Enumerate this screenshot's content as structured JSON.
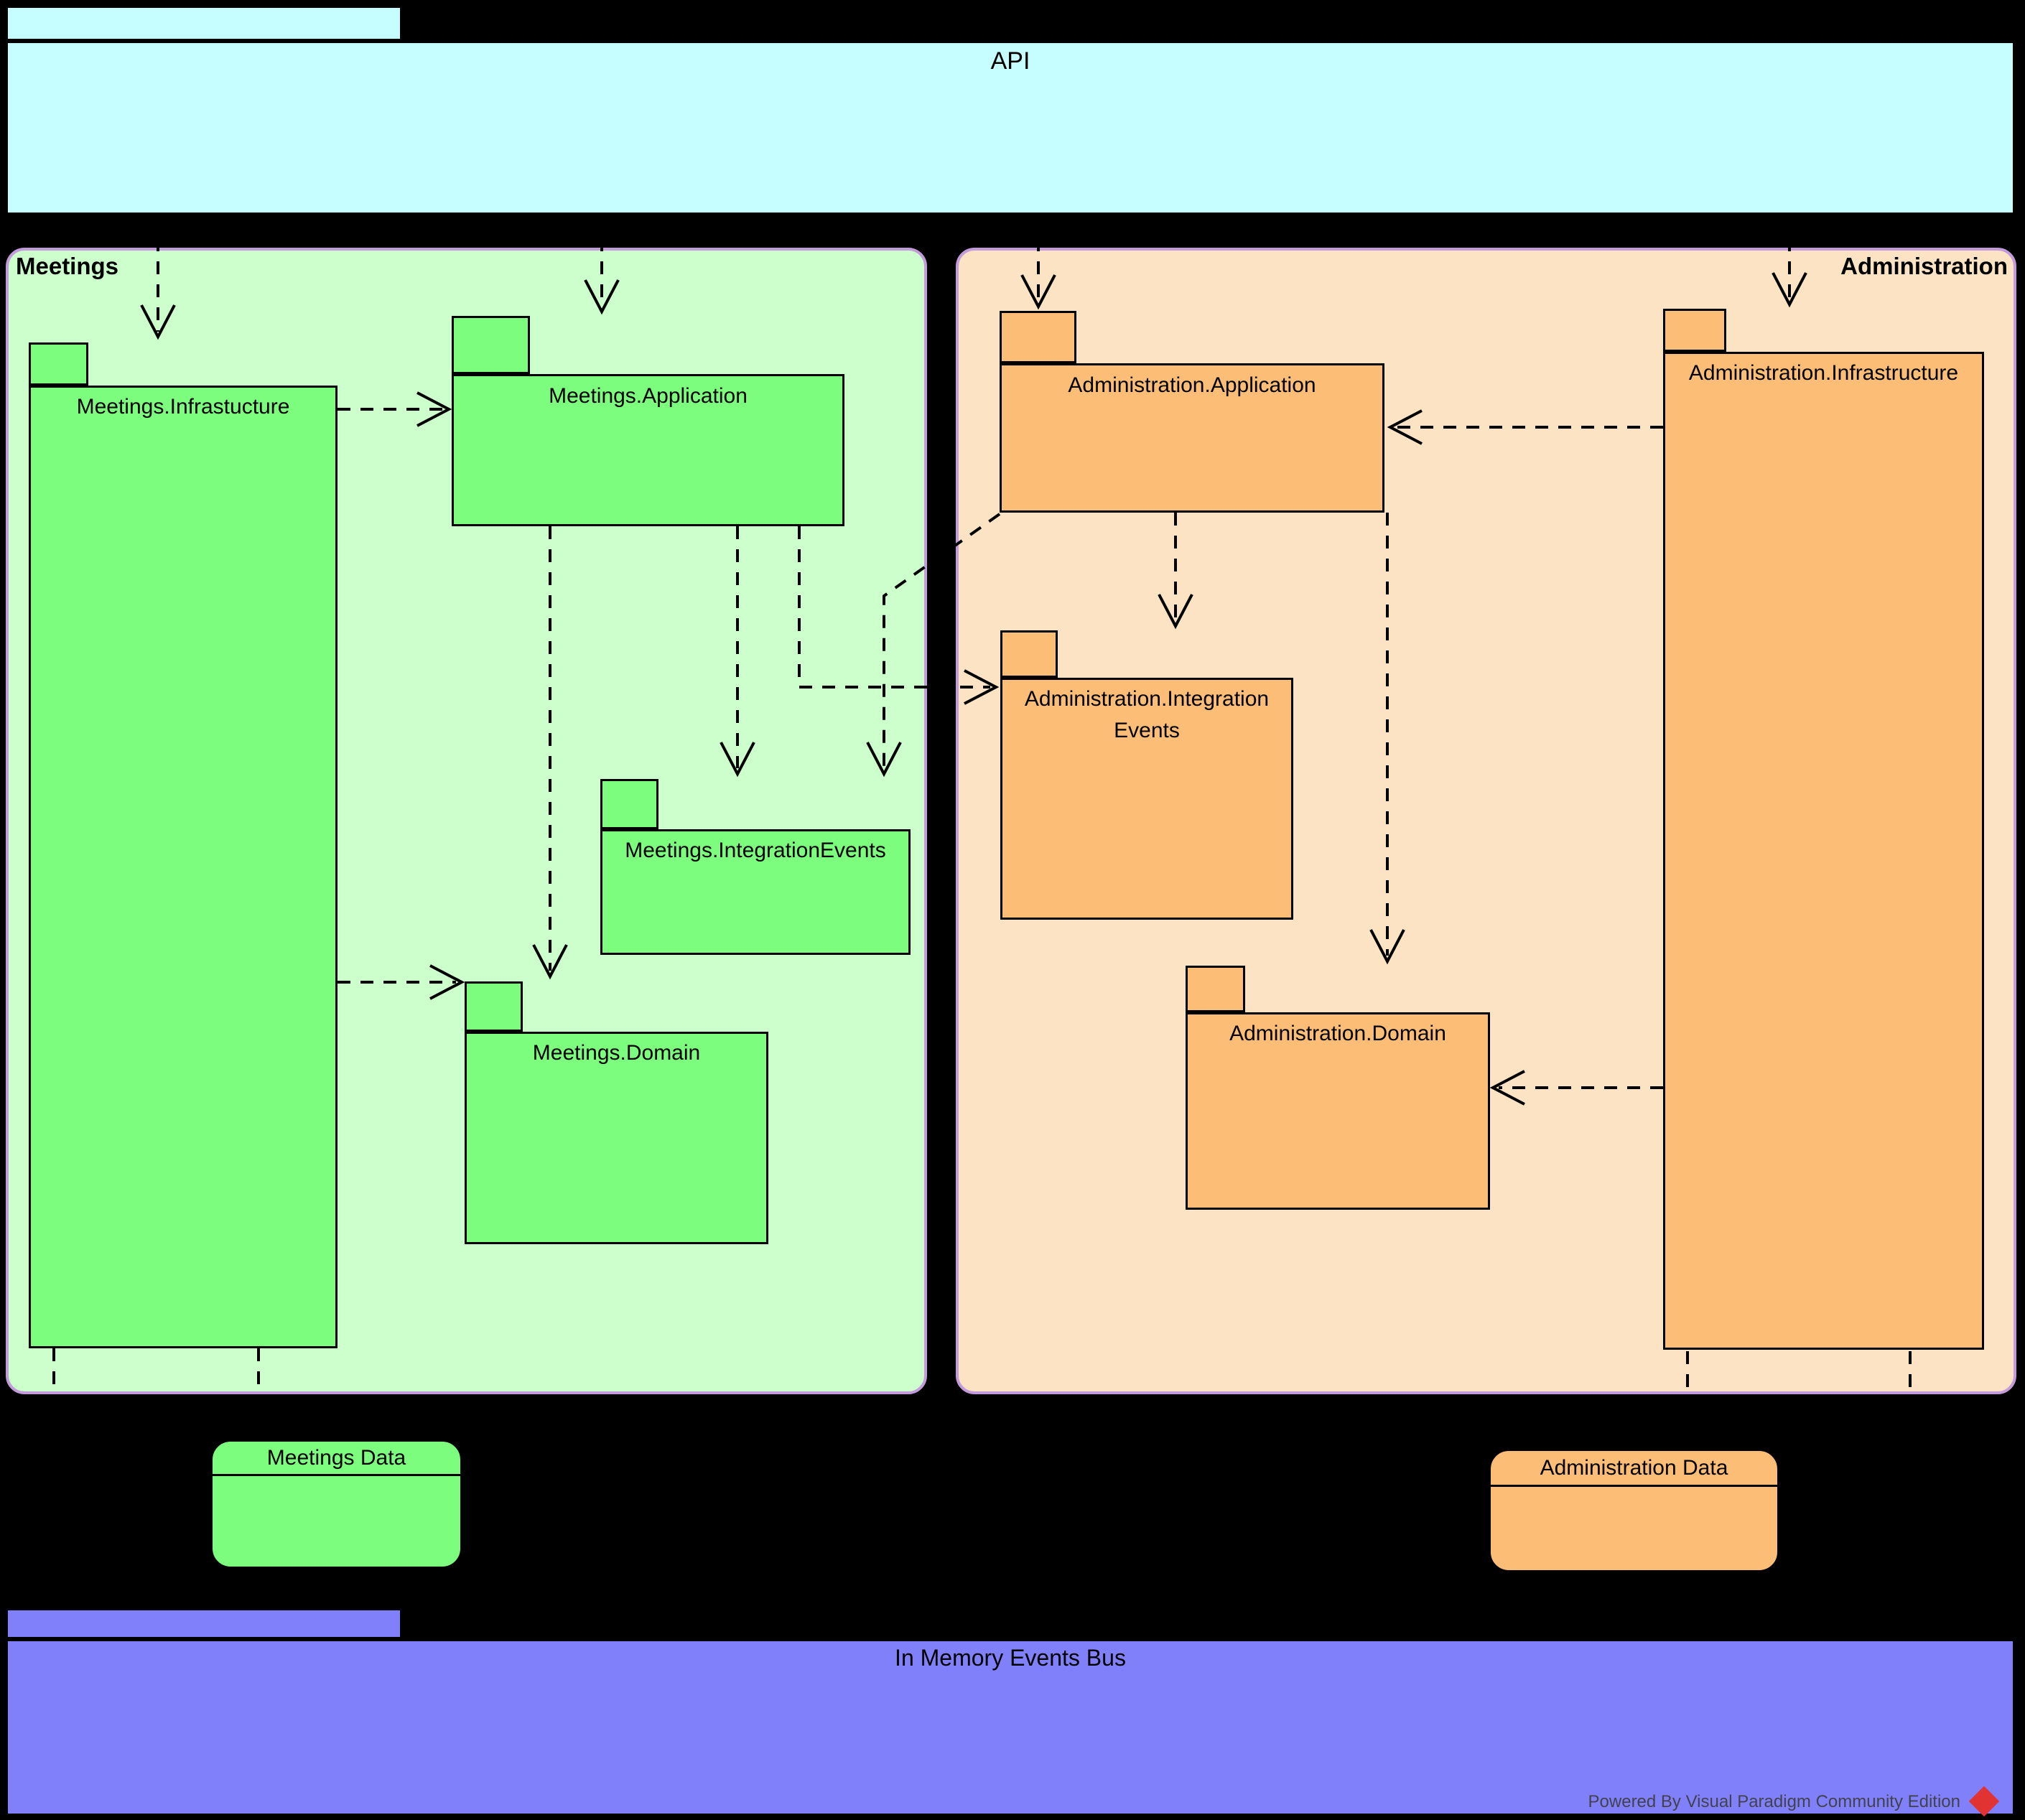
{
  "diagram_type": "UML package / architecture diagram",
  "api": {
    "label": "API"
  },
  "modules": {
    "meetings": {
      "label": "Meetings",
      "packages": {
        "infrastructure": {
          "label": "Meetings.Infrastucture"
        },
        "application": {
          "label": "Meetings.Application"
        },
        "integration_events": {
          "label": "Meetings.IntegrationEvents"
        },
        "domain": {
          "label": "Meetings.Domain"
        }
      },
      "data_store": {
        "label": "Meetings Data"
      }
    },
    "administration": {
      "label": "Administration",
      "packages": {
        "application": {
          "label": "Administration.Application"
        },
        "integration_events": {
          "label": "Administration.Integration Events"
        },
        "domain": {
          "label": "Administration.Domain"
        },
        "infrastructure": {
          "label": "Administration.Infrastructure"
        }
      },
      "data_store": {
        "label": "Administration Data"
      }
    }
  },
  "events_bus": {
    "label": "In Memory Events Bus"
  },
  "watermark": {
    "text": "Powered By Visual Paradigm Community Edition"
  },
  "connections": [
    {
      "from": "api",
      "to": "meetings-infrastructure",
      "style": "dashed-dependency"
    },
    {
      "from": "api",
      "to": "meetings-application",
      "style": "dashed-dependency"
    },
    {
      "from": "api",
      "to": "administration-application",
      "style": "dashed-dependency"
    },
    {
      "from": "api",
      "to": "administration-infrastructure",
      "style": "dashed-dependency"
    },
    {
      "from": "meetings-infrastructure",
      "to": "meetings-application",
      "style": "dashed-dependency"
    },
    {
      "from": "meetings-infrastructure",
      "to": "meetings-domain",
      "style": "dashed-dependency"
    },
    {
      "from": "meetings-application",
      "to": "meetings-domain",
      "style": "dashed-dependency"
    },
    {
      "from": "meetings-application",
      "to": "meetings-integration-events",
      "style": "dashed-dependency"
    },
    {
      "from": "meetings-application",
      "to": "administration-integration-events",
      "style": "dashed-dependency"
    },
    {
      "from": "administration-application",
      "to": "meetings-integration-events",
      "style": "dashed-dependency"
    },
    {
      "from": "administration-application",
      "to": "administration-integration-events",
      "style": "dashed-dependency"
    },
    {
      "from": "administration-application",
      "to": "administration-domain",
      "style": "dashed-dependency"
    },
    {
      "from": "administration-infrastructure",
      "to": "administration-application",
      "style": "dashed-dependency"
    },
    {
      "from": "administration-infrastructure",
      "to": "administration-domain",
      "style": "dashed-dependency"
    },
    {
      "from": "meetings-infrastructure",
      "to": "below-container-edge",
      "style": "dashed-stub"
    },
    {
      "from": "meetings-infrastructure",
      "to": "below-container-edge",
      "style": "dashed-stub"
    },
    {
      "from": "administration-infrastructure",
      "to": "below-container-edge",
      "style": "dashed-stub"
    },
    {
      "from": "administration-infrastructure",
      "to": "below-container-edge",
      "style": "dashed-stub"
    }
  ],
  "colors": {
    "background": "#000000",
    "api-fill": "#C6FEFF",
    "meetings-container-fill": "#CCFFCC",
    "administration-container-fill": "#FBE3C4",
    "container-border": "#C39BDB",
    "meetings-package-fill": "#7DFD7D",
    "administration-package-fill": "#FCBD77",
    "bus-fill": "#8080FB",
    "line-color": "#000000",
    "watermark-text": "#42424D",
    "watermark-logo": "#E23333"
  }
}
